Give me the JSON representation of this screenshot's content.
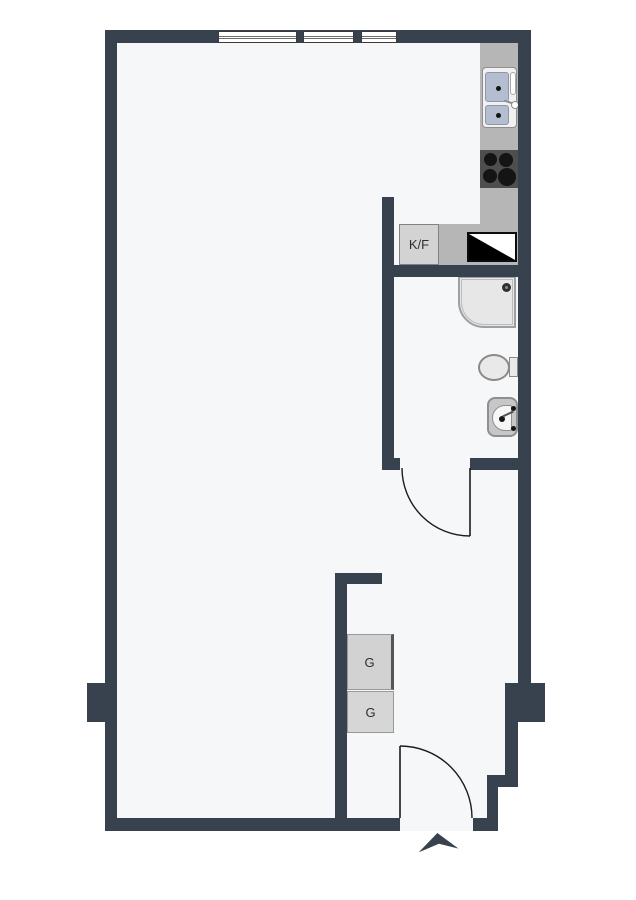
{
  "floorplan": {
    "labels": {
      "fridge_freezer": "K/F",
      "wardrobe_upper": "G",
      "wardrobe_lower": "G"
    },
    "colors": {
      "wall": "#37424e",
      "floor": "#f6f7f8",
      "page_background": "#ffffff",
      "counter": "#b6b6b6",
      "cabinet_fill": "#d3d3d3",
      "stove_fill": "#4e4e4e",
      "burner": "#141414",
      "sink_basin": "#b5bed0",
      "fixture_fill": "#e9e9e9",
      "washbasin_fill": "#c7c7c7",
      "wardrobe_fill": "#d4d4d4",
      "dishwasher_black": "#000000",
      "door_swing_line": "#1c1c1c"
    },
    "symbols": {
      "windows_on_top_wall": 3,
      "door_swings": 2,
      "north_arrow": "chevron-up",
      "kitchen": [
        "double-basin-sink",
        "four-burner-stove",
        "fridge-freezer-cabinet",
        "dishwasher-diagonal-symbol",
        "counter"
      ],
      "bathroom": [
        "shower",
        "toilet",
        "washbasin"
      ],
      "hall": [
        "wardrobe",
        "wardrobe"
      ]
    }
  }
}
